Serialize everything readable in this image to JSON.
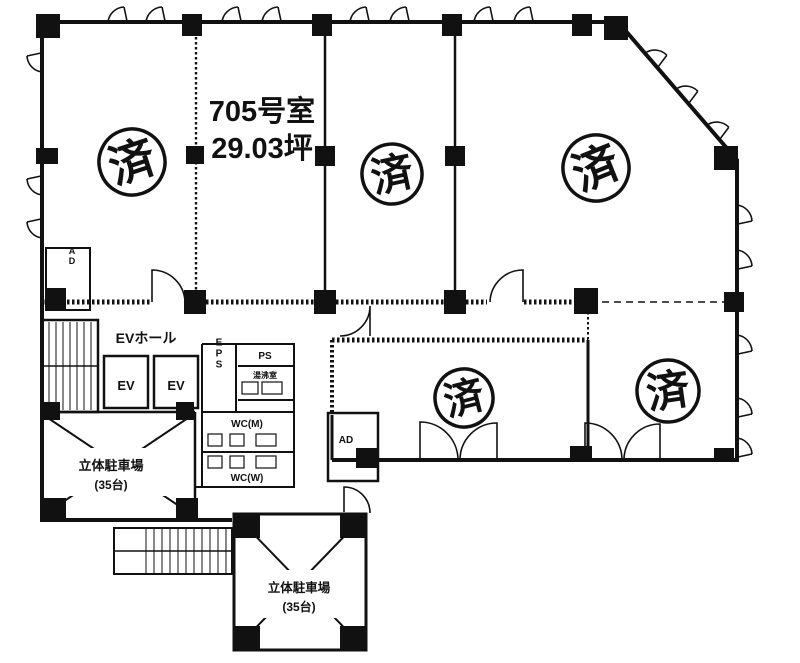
{
  "floorplan": {
    "unit": {
      "room_label": "705号室",
      "area_label": "29.03坪"
    },
    "stamp": {
      "char": "済"
    },
    "rooms": {
      "ev_hall": "EVホール",
      "elevator": "EV",
      "eps": "EPS",
      "ps": "PS",
      "kitchenette": "湯沸室",
      "wc_m": "WC(M)",
      "wc_w": "WC(W)",
      "ad": "AD",
      "parking_line1": "立体駐車場",
      "parking_line2": "(35台)"
    },
    "colors": {
      "ink": "#111111",
      "paper": "#ffffff"
    }
  }
}
